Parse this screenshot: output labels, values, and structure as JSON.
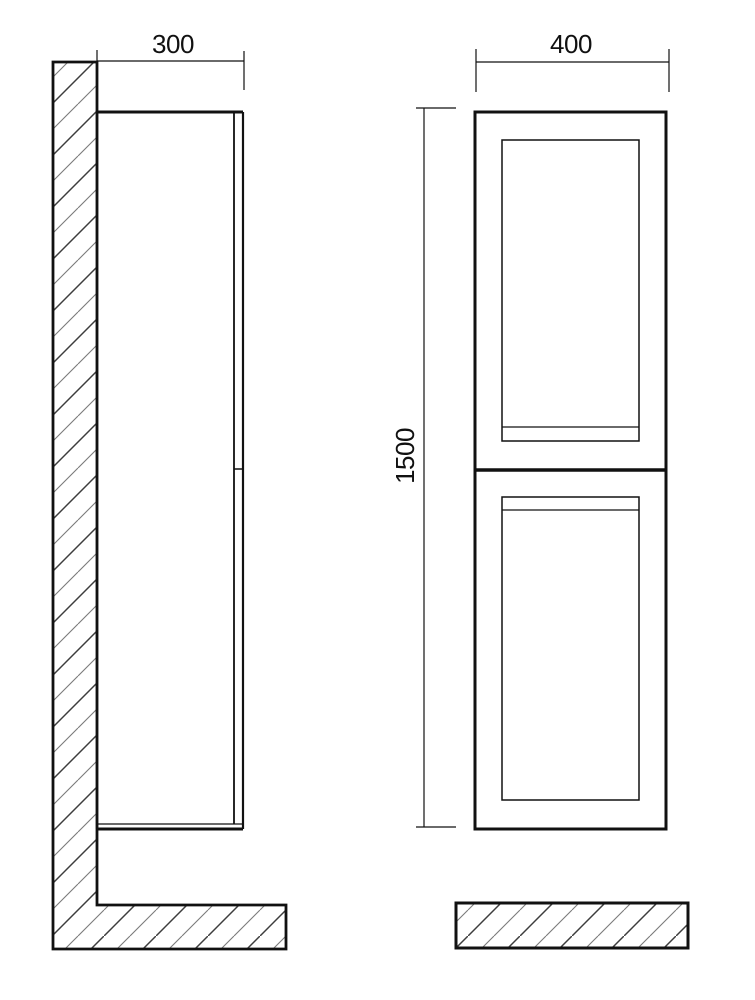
{
  "drawing": {
    "type": "technical-drawing",
    "subject": "tall wall-hung two-door cabinet, side and front elevation",
    "dimensions": {
      "side_depth": "300",
      "front_width": "400",
      "front_height": "1500"
    },
    "colors": {
      "line": "#111111",
      "hatch_dark": "#3d3d3d",
      "hatch_light": "#7a7a7a",
      "background": "#ffffff"
    }
  }
}
